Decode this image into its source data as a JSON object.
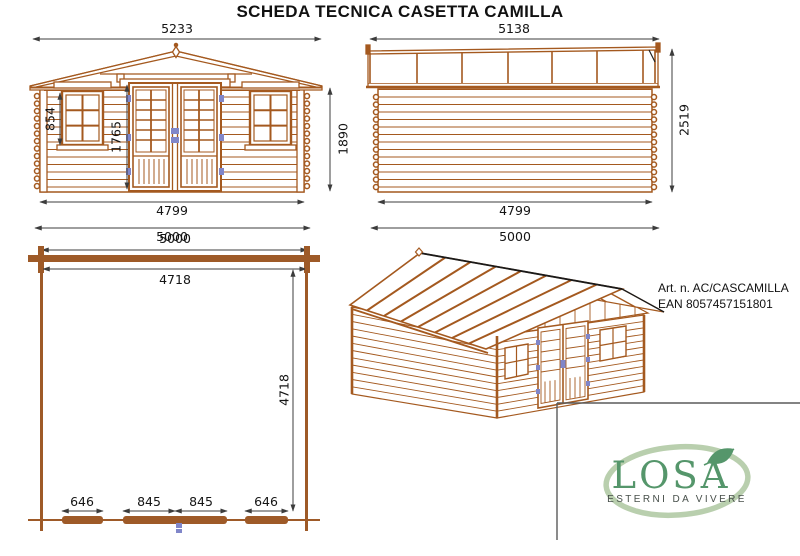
{
  "title": "SCHEDA TECNICA CASETTA CAMILLA",
  "front_view": {
    "roof_width": "5233",
    "window_height": "854",
    "door_height": "1765",
    "wall_height": "1890",
    "wall_width": "4799",
    "base_width": "5000"
  },
  "side_view": {
    "roof_width": "5138",
    "total_height": "2519",
    "wall_width": "4799",
    "base_width": "5000"
  },
  "plan_view": {
    "outer_width": "5000",
    "inner_width": "4718",
    "inner_depth": "4718",
    "segments": [
      "646",
      "845",
      "845",
      "646"
    ]
  },
  "product": {
    "article": "Art. n. AC/CASCAMILLA",
    "ean": "EAN 8057457151801"
  },
  "logo": {
    "name": "LOSA",
    "tagline": "ESTERNI DA VIVERE"
  },
  "colors": {
    "wood": "#a4591f",
    "wood_fill": "#9e5a28",
    "hinge_blue": "#8086c9",
    "dim": "#3c3c3c",
    "logo_green": "#55966b",
    "logo_oval": "#b9cfae",
    "tagline_gray": "#474f4a"
  }
}
